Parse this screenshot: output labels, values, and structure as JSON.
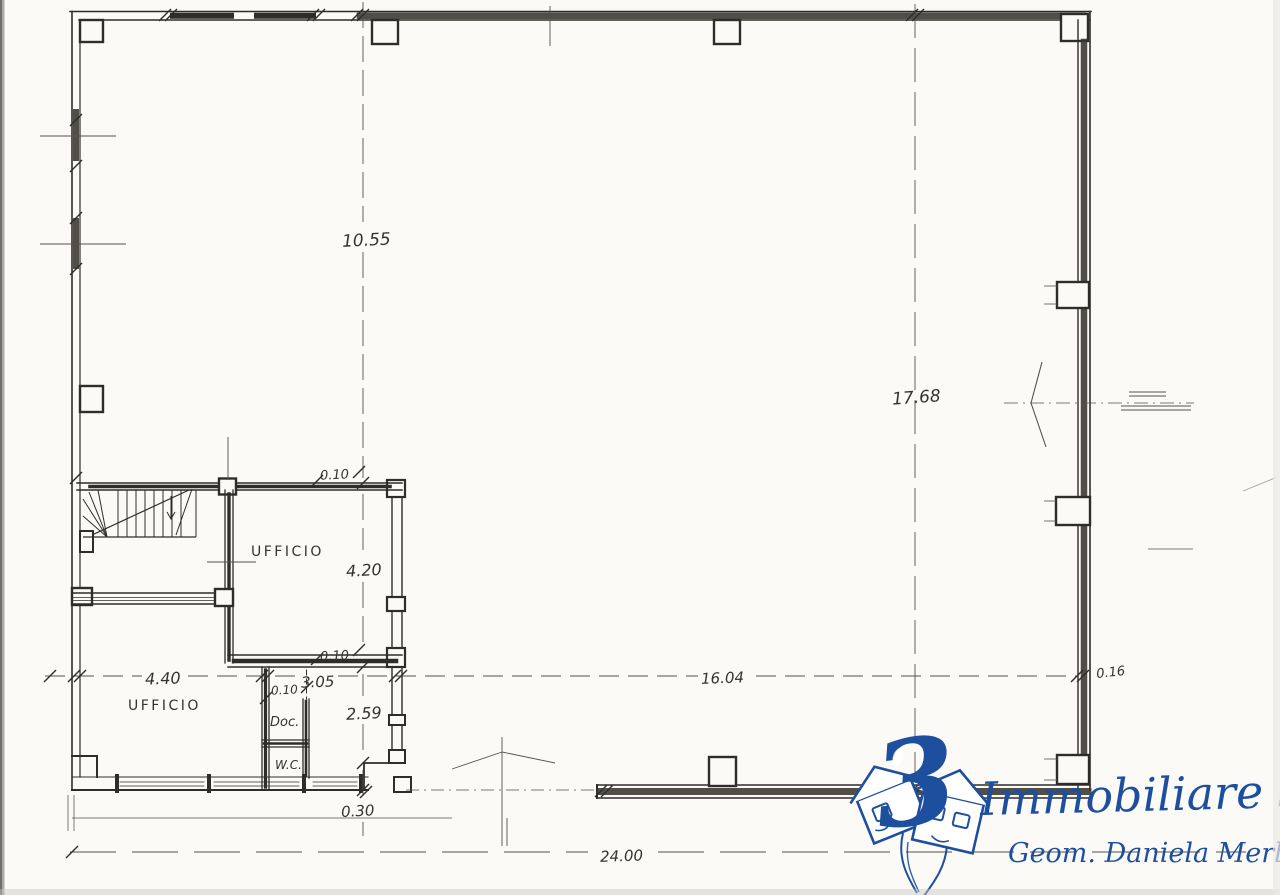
{
  "palette": {
    "paper": "#fbfaf6",
    "ink": "#2e2d2b",
    "dim_ink": "#54524d",
    "logo_blue": "#1e4f9e"
  },
  "plan": {
    "labels": {
      "office_upper": "UFFICIO",
      "office_lower": "UFFICIO",
      "archive": "Doc.",
      "wc": "W.C."
    },
    "dims": {
      "top_span": "10.55",
      "hall_depth": "17.68",
      "wall_upper": "0.10",
      "office_upper_depth": "4.20",
      "wall_lower": "0.10",
      "office_lower_width": "4.40",
      "corridor_span": "3.05",
      "closet_gap": "0.10",
      "corridor_depth": "2.59",
      "front_span": "16.04",
      "right_wall": "0.16",
      "threshold": "0.30",
      "overall_width": "24.00"
    }
  },
  "logo": {
    "numeral": "3",
    "company": "Immobiliare 3",
    "signature": "Geom. Daniela Merlo"
  }
}
